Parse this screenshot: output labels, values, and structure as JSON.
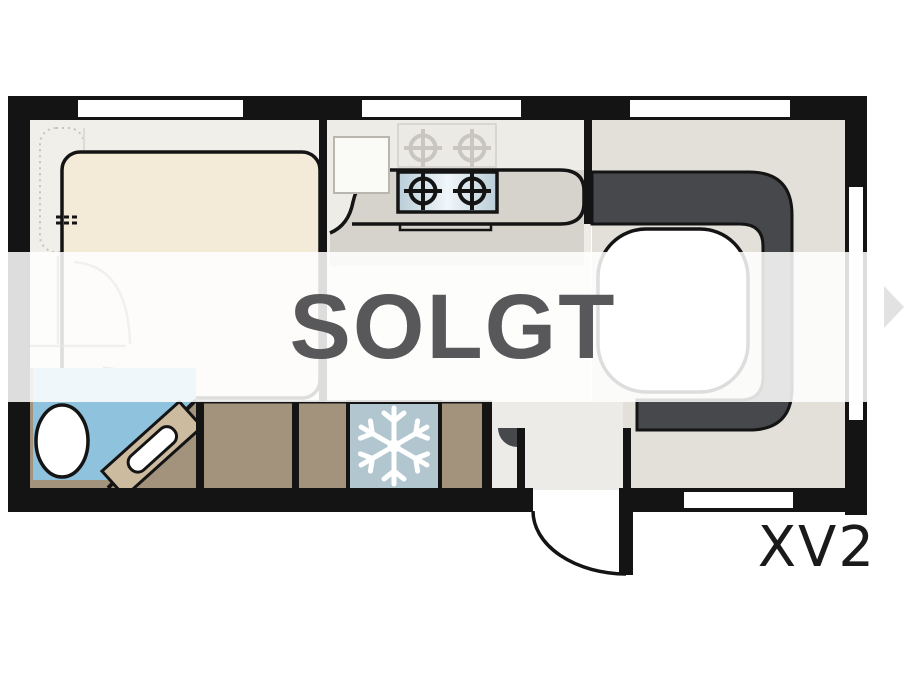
{
  "overlay": {
    "sold_label": "SOLGT",
    "text_color": "#58585a",
    "banner_background": "rgba(255,255,255,0.86)"
  },
  "plan": {
    "model_label": "XV2",
    "model_color": "#1a1a1a",
    "rooms": [
      "bedroom",
      "kitchen",
      "lounge",
      "bathroom",
      "entry"
    ],
    "icons": [
      {
        "name": "snowflake-icon",
        "meaning": "refrigerator-freezer"
      },
      {
        "name": "burner-icon",
        "meaning": "gas-hob"
      },
      {
        "name": "next-arrow-icon",
        "meaning": "carousel-next"
      }
    ],
    "colors": {
      "wall": "#141414",
      "bed": "#f4ead8",
      "sofa": "#46484c",
      "shower_blue": "#8fc2dc",
      "cabinet_brown": "#a3937d",
      "fridge_blue": "#b2c6d0",
      "counter_gray": "#d6d2cc",
      "arrow_gray": "#e2e2e2"
    }
  }
}
